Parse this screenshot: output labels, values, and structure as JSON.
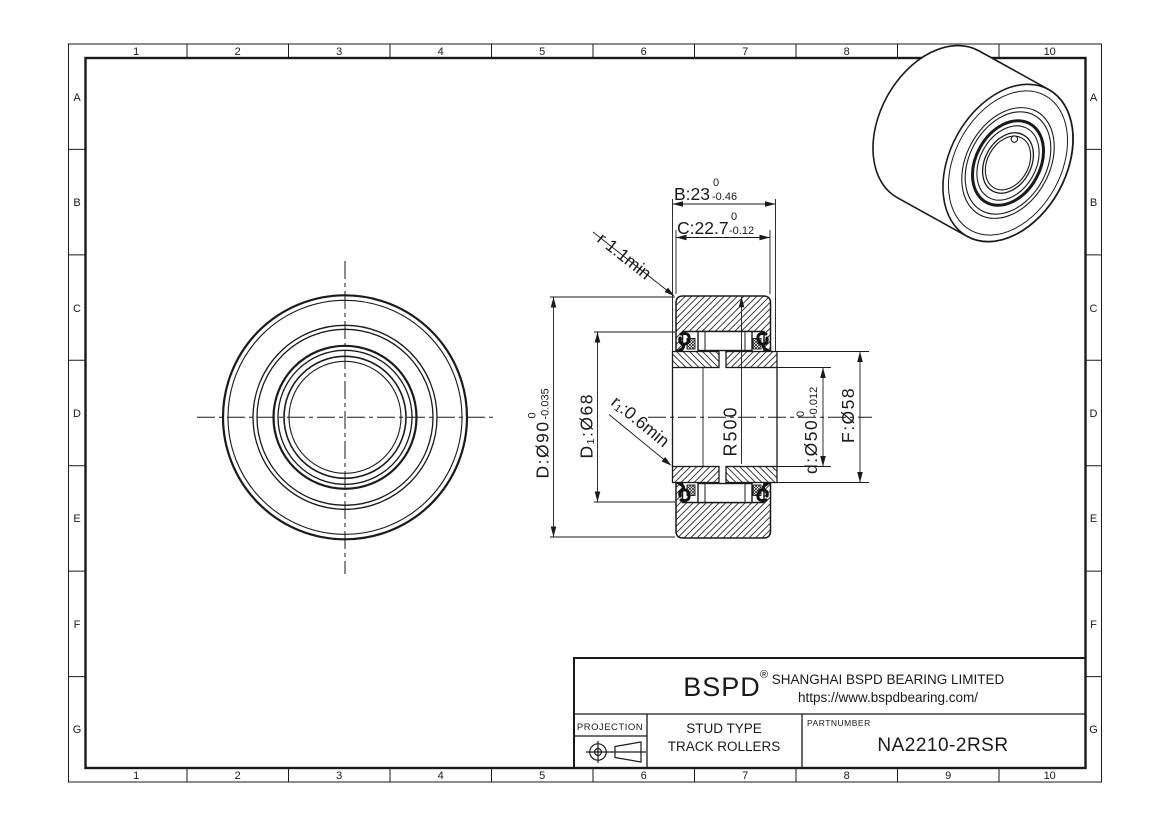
{
  "sheet": {
    "grid": {
      "columns": [
        "1",
        "2",
        "3",
        "4",
        "5",
        "6",
        "7",
        "8",
        "9",
        "10"
      ],
      "rows": [
        "A",
        "B",
        "C",
        "D",
        "E",
        "F",
        "G"
      ]
    },
    "line_color": "#1a1a1a"
  },
  "dims": {
    "B": {
      "value": "B:23",
      "tol_top": "0",
      "tol_bottom": "-0.46"
    },
    "C": {
      "value": "C:22.7",
      "tol_top": "0",
      "tol_bottom": "-0.12"
    },
    "r": {
      "label": "r 1.1min"
    },
    "D": {
      "value": "D:Ø90",
      "tol_top": "0",
      "tol_bottom": "-0.035"
    },
    "D1": {
      "value": "D₁:Ø68"
    },
    "r1": {
      "label": "r₁:0.6min"
    },
    "R": {
      "value": "R500"
    },
    "d": {
      "value": "d:Ø50",
      "tol_top": "0",
      "tol_bottom": "-0.012"
    },
    "F": {
      "value": "F:Ø58"
    }
  },
  "title_block": {
    "logo": "BSPD",
    "registered": "®",
    "company": "SHANGHAI BSPD BEARING LIMITED",
    "website": "https://www.bspdbearing.com/",
    "projection_label": "PROJECTION",
    "product_line1": "STUD TYPE",
    "product_line2": "TRACK ROLLERS",
    "part_label": "PARTNUMBER",
    "part_number": "NA2210-2RSR"
  }
}
